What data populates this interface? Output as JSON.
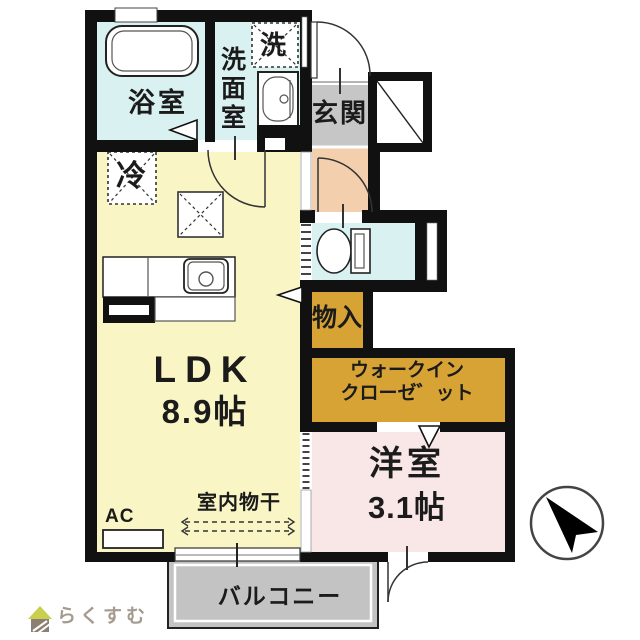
{
  "rooms": {
    "bathroom": "浴室",
    "washer": "洗",
    "washroom": "洗面室",
    "entrance": "玄関",
    "fridge": "冷",
    "ldk_name": "LDK",
    "ldk_size": "8.9帖",
    "storage": "物入",
    "wic_line1": "ウォークイン",
    "wic_line2": "クローゼ゛ット",
    "western_name": "洋室",
    "western_size": "3.1帖",
    "drying": "室内物干",
    "ac": "AC",
    "balcony": "バルコニー"
  },
  "logo": {
    "text": "らくすむ"
  },
  "colors": {
    "wall": "#111111",
    "wet_area": "#d9f2f1",
    "ldk": "#f9f5c4",
    "hallway": "#f3cfad",
    "entrance_floor": "#c6c6c6",
    "storage": "#d7a335",
    "western_room": "#f9e7e7",
    "balcony": "#c3c3c3",
    "logo_roof": "#c9cf4e",
    "logo_body": "#8d8073",
    "logo_text": "#a59a8e"
  }
}
